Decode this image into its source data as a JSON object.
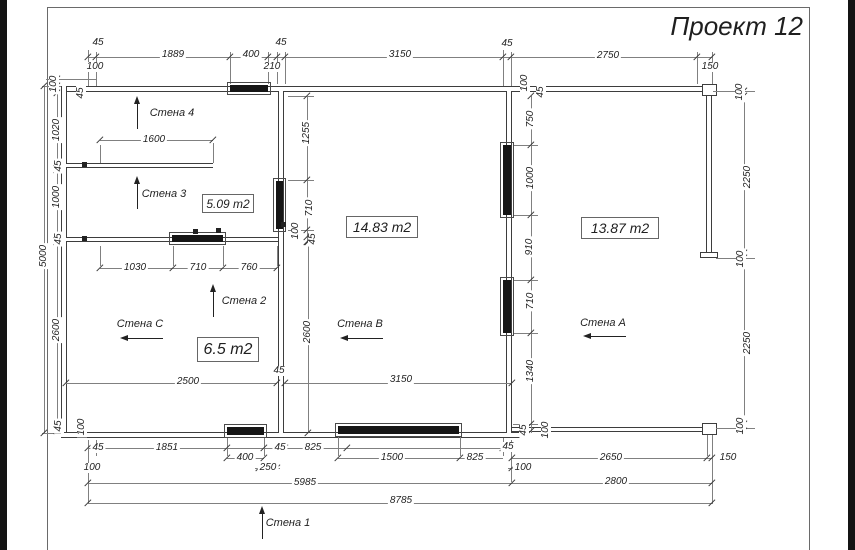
{
  "title": "Проект 12",
  "colors": {
    "ink": "#3d3d3d",
    "dim": "#808080",
    "text": "#1f1f1f",
    "paper": "#ffffff",
    "band": "#141414"
  },
  "plan": {
    "walls": [
      [
        61,
        86,
        651,
        6,
        "h"
      ],
      [
        61,
        86,
        6,
        352,
        "v"
      ],
      [
        61,
        432,
        459,
        6,
        "h"
      ],
      [
        512,
        427,
        200,
        5,
        "h"
      ],
      [
        278,
        91,
        6,
        342,
        "v"
      ],
      [
        506,
        91,
        6,
        342,
        "v"
      ],
      [
        66,
        163,
        147,
        5,
        "h"
      ],
      [
        66,
        237,
        212,
        5,
        "h"
      ],
      [
        706,
        96,
        6,
        162,
        "v"
      ]
    ],
    "outlines": [
      [
        702,
        84,
        15,
        12
      ],
      [
        702,
        423,
        15,
        12
      ],
      [
        700,
        252,
        18,
        6
      ]
    ],
    "windows": [
      [
        230,
        85,
        38,
        7
      ],
      [
        172,
        235,
        51,
        7
      ],
      [
        276,
        181,
        7,
        48
      ],
      [
        503,
        145,
        8,
        70
      ],
      [
        503,
        280,
        8,
        53
      ],
      [
        227,
        427,
        37,
        8
      ],
      [
        338,
        426,
        121,
        8
      ]
    ],
    "notches": [
      [
        84,
        164
      ],
      [
        84,
        238
      ],
      [
        195,
        231
      ],
      [
        283,
        224
      ],
      [
        218,
        230
      ]
    ],
    "hlines": [
      [
        88,
        57,
        624
      ],
      [
        100,
        140,
        113
      ],
      [
        100,
        268,
        177
      ],
      [
        66,
        383,
        211
      ],
      [
        285,
        383,
        227
      ],
      [
        88,
        448,
        424
      ],
      [
        227,
        458,
        37
      ],
      [
        338,
        458,
        165
      ],
      [
        512,
        458,
        200
      ],
      [
        84,
        468,
        16
      ],
      [
        255,
        468,
        25
      ],
      [
        508,
        468,
        19
      ],
      [
        88,
        483,
        424
      ],
      [
        512,
        483,
        200
      ],
      [
        88,
        503,
        624
      ],
      [
        713,
        91,
        42
      ],
      [
        716,
        258,
        39
      ],
      [
        716,
        428,
        39
      ],
      [
        42,
        86,
        19
      ],
      [
        42,
        433,
        19
      ],
      [
        46,
        79,
        50
      ],
      [
        288,
        96,
        26
      ],
      [
        288,
        180,
        26
      ],
      [
        288,
        230,
        26
      ],
      [
        513,
        145,
        25
      ],
      [
        513,
        215,
        25
      ],
      [
        513,
        280,
        25
      ],
      [
        513,
        333,
        25
      ],
      [
        513,
        424,
        25
      ]
    ],
    "vlines": [
      [
        57,
        79,
        354
      ],
      [
        44,
        86,
        347
      ],
      [
        88,
        50,
        36
      ],
      [
        96,
        52,
        34
      ],
      [
        230,
        52,
        32
      ],
      [
        268,
        52,
        32
      ],
      [
        277,
        52,
        32
      ],
      [
        285,
        52,
        32
      ],
      [
        503,
        50,
        36
      ],
      [
        511,
        52,
        34
      ],
      [
        697,
        52,
        32
      ],
      [
        712,
        52,
        32
      ],
      [
        100,
        145,
        18
      ],
      [
        213,
        143,
        20
      ],
      [
        307,
        96,
        146
      ],
      [
        531,
        96,
        337
      ],
      [
        308,
        242,
        191
      ],
      [
        744,
        91,
        342
      ],
      [
        100,
        246,
        20
      ],
      [
        173,
        246,
        20
      ],
      [
        223,
        246,
        20
      ],
      [
        277,
        246,
        20
      ],
      [
        88,
        440,
        64
      ],
      [
        96,
        440,
        16
      ],
      [
        227,
        438,
        18
      ],
      [
        264,
        438,
        18
      ],
      [
        338,
        436,
        20
      ],
      [
        460,
        436,
        20
      ],
      [
        503,
        438,
        18
      ],
      [
        511,
        440,
        42
      ],
      [
        707,
        435,
        21
      ],
      [
        712,
        435,
        69
      ]
    ],
    "ticks": [
      [
        88,
        57
      ],
      [
        96,
        57
      ],
      [
        230,
        57
      ],
      [
        268,
        57
      ],
      [
        277,
        57
      ],
      [
        285,
        57
      ],
      [
        503,
        57
      ],
      [
        511,
        57
      ],
      [
        697,
        57
      ],
      [
        712,
        57
      ],
      [
        100,
        140
      ],
      [
        213,
        140
      ],
      [
        100,
        268
      ],
      [
        173,
        268
      ],
      [
        223,
        268
      ],
      [
        277,
        268
      ],
      [
        66,
        383
      ],
      [
        277,
        383
      ],
      [
        285,
        383
      ],
      [
        512,
        383
      ],
      [
        88,
        448
      ],
      [
        96,
        448
      ],
      [
        227,
        448
      ],
      [
        264,
        448
      ],
      [
        277,
        448
      ],
      [
        285,
        448
      ],
      [
        347,
        448
      ],
      [
        503,
        448
      ],
      [
        511,
        448
      ],
      [
        227,
        458
      ],
      [
        264,
        458
      ],
      [
        338,
        458
      ],
      [
        460,
        458
      ],
      [
        512,
        458
      ],
      [
        707,
        458
      ],
      [
        712,
        458
      ],
      [
        88,
        468
      ],
      [
        96,
        468
      ],
      [
        259,
        468
      ],
      [
        277,
        468
      ],
      [
        512,
        468
      ],
      [
        519,
        468
      ],
      [
        88,
        483
      ],
      [
        512,
        483
      ],
      [
        712,
        483
      ],
      [
        88,
        503
      ],
      [
        712,
        503
      ],
      [
        57,
        79
      ],
      [
        57,
        86
      ],
      [
        57,
        93
      ],
      [
        57,
        163
      ],
      [
        57,
        170
      ],
      [
        57,
        235
      ],
      [
        57,
        242
      ],
      [
        57,
        424
      ],
      [
        57,
        431
      ],
      [
        44,
        86
      ],
      [
        44,
        433
      ],
      [
        307,
        96
      ],
      [
        307,
        180
      ],
      [
        307,
        230
      ],
      [
        307,
        237
      ],
      [
        307,
        242
      ],
      [
        531,
        96
      ],
      [
        531,
        145
      ],
      [
        531,
        215
      ],
      [
        531,
        280
      ],
      [
        531,
        333
      ],
      [
        531,
        424
      ],
      [
        531,
        431
      ],
      [
        308,
        242
      ],
      [
        308,
        433
      ],
      [
        744,
        91
      ],
      [
        744,
        96
      ],
      [
        744,
        253
      ],
      [
        744,
        258
      ],
      [
        744,
        424
      ],
      [
        744,
        431
      ]
    ],
    "labels": [
      [
        "45",
        98,
        43
      ],
      [
        "1889",
        173,
        55
      ],
      [
        "400",
        251,
        55
      ],
      [
        "45",
        281,
        43
      ],
      [
        "3150",
        400,
        55
      ],
      [
        "45",
        507,
        44
      ],
      [
        "2750",
        608,
        56
      ],
      [
        "100",
        95,
        67
      ],
      [
        "210",
        272,
        67
      ],
      [
        "150",
        710,
        67
      ],
      [
        "100",
        54,
        84,
        -90
      ],
      [
        "45",
        81,
        93,
        -90
      ],
      [
        "1020",
        57,
        130,
        -90
      ],
      [
        "45",
        59,
        166,
        -90
      ],
      [
        "1000",
        57,
        197,
        -90
      ],
      [
        "45",
        59,
        239,
        -90
      ],
      [
        "5000",
        44,
        256,
        -90
      ],
      [
        "2600",
        57,
        330,
        -90
      ],
      [
        "45",
        59,
        426,
        -90
      ],
      [
        "100",
        82,
        427,
        -90
      ],
      [
        "1600",
        154,
        140
      ],
      [
        "1030",
        135,
        268
      ],
      [
        "710",
        198,
        268
      ],
      [
        "760",
        249,
        268
      ],
      [
        "2500",
        188,
        382
      ],
      [
        "45",
        279,
        371
      ],
      [
        "2600",
        308,
        332,
        -90
      ],
      [
        "3150",
        401,
        380
      ],
      [
        "1255",
        307,
        133,
        -90
      ],
      [
        "710",
        310,
        208,
        -90
      ],
      [
        "100",
        296,
        231,
        -90
      ],
      [
        "45",
        313,
        239,
        -90
      ],
      [
        "100",
        525,
        83,
        -90
      ],
      [
        "45",
        541,
        92,
        -90
      ],
      [
        "750",
        531,
        119,
        -90
      ],
      [
        "1000",
        531,
        178,
        -90
      ],
      [
        "910",
        530,
        247,
        -90
      ],
      [
        "710",
        531,
        301,
        -90
      ],
      [
        "1340",
        531,
        371,
        -90
      ],
      [
        "45",
        524,
        430,
        -90
      ],
      [
        "100",
        546,
        430,
        -90
      ],
      [
        "100",
        740,
        92,
        -90
      ],
      [
        "2250",
        748,
        177,
        -90
      ],
      [
        "100",
        741,
        259,
        -90
      ],
      [
        "2250",
        748,
        343,
        -90
      ],
      [
        "100",
        741,
        426,
        -90
      ],
      [
        "45",
        98,
        448
      ],
      [
        "1851",
        167,
        448
      ],
      [
        "45",
        280,
        448
      ],
      [
        "825",
        313,
        448
      ],
      [
        "400",
        245,
        458
      ],
      [
        "250",
        268,
        468
      ],
      [
        "1500",
        392,
        458
      ],
      [
        "825",
        475,
        458
      ],
      [
        "100",
        92,
        468
      ],
      [
        "45",
        508,
        447
      ],
      [
        "100",
        523,
        468
      ],
      [
        "2650",
        611,
        458
      ],
      [
        "150",
        728,
        458
      ],
      [
        "5985",
        305,
        483
      ],
      [
        "2800",
        616,
        482
      ],
      [
        "8785",
        401,
        501
      ]
    ],
    "rooms": [
      [
        "5.09 m2",
        202,
        194,
        52,
        19,
        12
      ],
      [
        "14.83 m2",
        346,
        216,
        72,
        22,
        14
      ],
      [
        "13.87 m2",
        581,
        217,
        78,
        22,
        14
      ],
      [
        "6.5 m2",
        197,
        337,
        62,
        25,
        16
      ]
    ],
    "wall_markers": [
      [
        "Стена 4",
        172,
        113,
        "up",
        137,
        96
      ],
      [
        "Стена 3",
        164,
        194,
        "up",
        137,
        176
      ],
      [
        "Стена 2",
        244,
        301,
        "up",
        213,
        284
      ],
      [
        "Стена 1",
        288,
        523,
        "up",
        262,
        506
      ],
      [
        "Стена C",
        140,
        324,
        "left",
        120,
        338
      ],
      [
        "Стена B",
        360,
        324,
        "left",
        340,
        338
      ],
      [
        "Стена A",
        603,
        323,
        "left",
        583,
        336
      ]
    ]
  }
}
